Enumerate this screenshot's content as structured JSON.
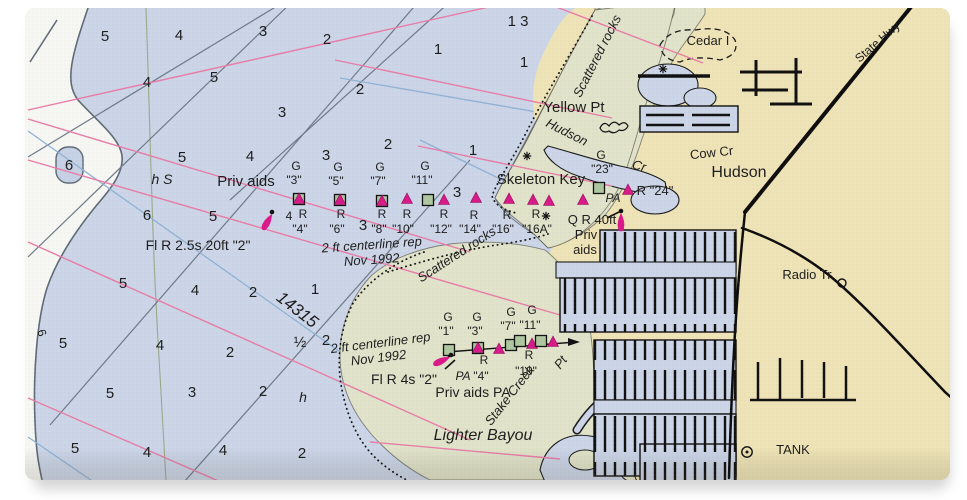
{
  "chart": {
    "chart_number": {
      "text": "14315",
      "x": 294,
      "y": 314,
      "rot": 38
    },
    "colors": {
      "water": "#cbd5e7",
      "deep": "#f6f6f2",
      "land": "#eee3b6",
      "marsh": "#e0e3c9",
      "magenta": "#d9198a",
      "green_marker": "#aec7a0",
      "pink_line": "#e87ca8",
      "blue_line": "#8fb2d4",
      "gray_line": "#6e7a88",
      "contour": "#5e6a76",
      "road": "#0d0d0d",
      "text": "#1c1c1c",
      "chart_number_blue": "#4a8fc0"
    },
    "soundings": [
      {
        "x": 105,
        "y": 41,
        "v": "5"
      },
      {
        "x": 179,
        "y": 40,
        "v": "4"
      },
      {
        "x": 263,
        "y": 36,
        "v": "3"
      },
      {
        "x": 327,
        "y": 44,
        "v": "2"
      },
      {
        "x": 438,
        "y": 54,
        "v": "1"
      },
      {
        "x": 524,
        "y": 67,
        "v": "1"
      },
      {
        "x": 360,
        "y": 94,
        "v": "2"
      },
      {
        "x": 147,
        "y": 87,
        "v": "4"
      },
      {
        "x": 214,
        "y": 82,
        "v": "5"
      },
      {
        "x": 282,
        "y": 117,
        "v": "3"
      },
      {
        "x": 182,
        "y": 162,
        "v": "5"
      },
      {
        "x": 250,
        "y": 161,
        "v": "4"
      },
      {
        "x": 147,
        "y": 220,
        "v": "6"
      },
      {
        "x": 213,
        "y": 221,
        "v": "5"
      },
      {
        "x": 326,
        "y": 160,
        "v": "3"
      },
      {
        "x": 388,
        "y": 149,
        "v": "2"
      },
      {
        "x": 473,
        "y": 155,
        "v": "1"
      },
      {
        "x": 457,
        "y": 197,
        "v": "3"
      },
      {
        "x": 363,
        "y": 230,
        "v": "3"
      },
      {
        "x": 123,
        "y": 288,
        "v": "5"
      },
      {
        "x": 195,
        "y": 295,
        "v": "4"
      },
      {
        "x": 253,
        "y": 297,
        "v": "2"
      },
      {
        "x": 315,
        "y": 294,
        "v": "1"
      },
      {
        "x": 63,
        "y": 348,
        "v": "5"
      },
      {
        "x": 160,
        "y": 350,
        "v": "4"
      },
      {
        "x": 230,
        "y": 357,
        "v": "2"
      },
      {
        "x": 300,
        "y": 347,
        "v": "½"
      },
      {
        "x": 326,
        "y": 345,
        "v": "2"
      },
      {
        "x": 110,
        "y": 398,
        "v": "5"
      },
      {
        "x": 192,
        "y": 397,
        "v": "3"
      },
      {
        "x": 263,
        "y": 396,
        "v": "2"
      },
      {
        "x": 75,
        "y": 453,
        "v": "5"
      },
      {
        "x": 147,
        "y": 457,
        "v": "4"
      },
      {
        "x": 223,
        "y": 455,
        "v": "4"
      },
      {
        "x": 302,
        "y": 458,
        "v": "2"
      },
      {
        "x": 518,
        "y": 26,
        "v": "1 3"
      },
      {
        "x": 69,
        "y": 170,
        "v": "6"
      }
    ],
    "labels": [
      {
        "t": "Priv aids",
        "x": 246,
        "y": 186,
        "s": 15
      },
      {
        "t": "Fl R 2.5s 20ft \"2\"",
        "x": 198,
        "y": 250,
        "s": 14
      },
      {
        "t": "2 ft centerline rep",
        "x": 372,
        "y": 249,
        "s": 13,
        "i": 1,
        "r": -4
      },
      {
        "t": "Nov 1992",
        "x": 372,
        "y": 264,
        "s": 13,
        "i": 1,
        "r": -4
      },
      {
        "t": "Scattered rocks",
        "x": 459,
        "y": 258,
        "s": 13,
        "i": 1,
        "r": -33
      },
      {
        "t": "Scattered rocks",
        "x": 601,
        "y": 58,
        "s": 13,
        "i": 1,
        "r": -63
      },
      {
        "t": "Yellow Pt",
        "x": 574,
        "y": 112,
        "s": 15
      },
      {
        "t": "Hudson",
        "x": 565,
        "y": 136,
        "s": 13,
        "i": 1,
        "r": 27
      },
      {
        "t": "Cr",
        "x": 638,
        "y": 170,
        "s": 13,
        "i": 1,
        "r": 15
      },
      {
        "t": "G",
        "x": 601,
        "y": 159,
        "s": 12
      },
      {
        "t": "\"23\"",
        "x": 602,
        "y": 173,
        "s": 12
      },
      {
        "t": "Skeleton Key",
        "x": 541,
        "y": 184,
        "s": 15
      },
      {
        "t": "Cedar I",
        "x": 708,
        "y": 45,
        "s": 13
      },
      {
        "t": "Cow Cr",
        "x": 712,
        "y": 157,
        "s": 13,
        "r": -6
      },
      {
        "t": "Hudson",
        "x": 739,
        "y": 177,
        "s": 16
      },
      {
        "t": "State Hwy",
        "x": 880,
        "y": 45,
        "s": 12,
        "r": -41
      },
      {
        "t": "Radio Tr",
        "x": 807,
        "y": 279,
        "s": 13
      },
      {
        "t": "TANK",
        "x": 793,
        "y": 454,
        "s": 13
      },
      {
        "t": "R \"24\"",
        "x": 655,
        "y": 195,
        "s": 13
      },
      {
        "t": "PA",
        "x": 613,
        "y": 202,
        "s": 12,
        "i": 1
      },
      {
        "t": "Q R 40ft",
        "x": 592,
        "y": 224,
        "s": 13
      },
      {
        "t": "Priv",
        "x": 586,
        "y": 239,
        "s": 13
      },
      {
        "t": "aids",
        "x": 585,
        "y": 254,
        "s": 13
      },
      {
        "t": "h S",
        "x": 162,
        "y": 184,
        "s": 14,
        "i": 1
      },
      {
        "t": "h",
        "x": 303,
        "y": 402,
        "s": 14,
        "i": 1
      },
      {
        "t": "6",
        "x": 38,
        "y": 334,
        "s": 12,
        "r": 72
      },
      {
        "t": "G",
        "x": 296,
        "y": 170,
        "s": 12
      },
      {
        "t": "\"3\"",
        "x": 294,
        "y": 184,
        "s": 12
      },
      {
        "t": "G",
        "x": 338,
        "y": 171,
        "s": 12
      },
      {
        "t": "\"5\"",
        "x": 336,
        "y": 185,
        "s": 12
      },
      {
        "t": "G",
        "x": 380,
        "y": 171,
        "s": 12
      },
      {
        "t": "\"7\"",
        "x": 378,
        "y": 185,
        "s": 12
      },
      {
        "t": "G",
        "x": 425,
        "y": 170,
        "s": 12
      },
      {
        "t": "\"11\"",
        "x": 422,
        "y": 184,
        "s": 12
      },
      {
        "t": "4",
        "x": 289,
        "y": 220,
        "s": 12
      },
      {
        "t": "R",
        "x": 303,
        "y": 218,
        "s": 12
      },
      {
        "t": "\"4\"",
        "x": 300,
        "y": 233,
        "s": 12
      },
      {
        "t": "R",
        "x": 341,
        "y": 218,
        "s": 12
      },
      {
        "t": "\"6\"",
        "x": 337,
        "y": 233,
        "s": 12
      },
      {
        "t": "R",
        "x": 382,
        "y": 218,
        "s": 12
      },
      {
        "t": "\"8\"",
        "x": 379,
        "y": 233,
        "s": 12
      },
      {
        "t": "R",
        "x": 407,
        "y": 218,
        "s": 12
      },
      {
        "t": "\"10\"",
        "x": 403,
        "y": 233,
        "s": 12
      },
      {
        "t": "R",
        "x": 444,
        "y": 218,
        "s": 12
      },
      {
        "t": "\"12\"",
        "x": 441,
        "y": 233,
        "s": 12
      },
      {
        "t": "R",
        "x": 474,
        "y": 219,
        "s": 12
      },
      {
        "t": "\"14\"",
        "x": 470,
        "y": 233,
        "s": 12
      },
      {
        "t": "R",
        "x": 507,
        "y": 219,
        "s": 12
      },
      {
        "t": "\"16\"",
        "x": 503,
        "y": 233,
        "s": 12
      },
      {
        "t": "R",
        "x": 536,
        "y": 218,
        "s": 12
      },
      {
        "t": "\"16A\"",
        "x": 537,
        "y": 233,
        "s": 12
      },
      {
        "t": "G",
        "x": 448,
        "y": 321,
        "s": 12
      },
      {
        "t": "\"1\"",
        "x": 446,
        "y": 335,
        "s": 12
      },
      {
        "t": "G",
        "x": 477,
        "y": 321,
        "s": 12
      },
      {
        "t": "\"3\"",
        "x": 475,
        "y": 335,
        "s": 12
      },
      {
        "t": "G",
        "x": 511,
        "y": 316,
        "s": 12
      },
      {
        "t": "\"7\"",
        "x": 508,
        "y": 330,
        "s": 12
      },
      {
        "t": "G",
        "x": 532,
        "y": 314,
        "s": 12
      },
      {
        "t": "\"11\"",
        "x": 530,
        "y": 329,
        "s": 12
      },
      {
        "t": "PA",
        "x": 463,
        "y": 380,
        "s": 12,
        "i": 1
      },
      {
        "t": "R",
        "x": 484,
        "y": 364,
        "s": 12
      },
      {
        "t": "\"4\"",
        "x": 481,
        "y": 380,
        "s": 12
      },
      {
        "t": "R",
        "x": 529,
        "y": 359,
        "s": 12
      },
      {
        "t": "\"10\"",
        "x": 526,
        "y": 375,
        "s": 12
      },
      {
        "t": "Fl R 4s \"2\"",
        "x": 404,
        "y": 384,
        "s": 14
      },
      {
        "t": "Priv aids PA",
        "x": 473,
        "y": 397,
        "s": 14
      },
      {
        "t": "2 ft centerline rep",
        "x": 381,
        "y": 347,
        "s": 13,
        "i": 1,
        "r": -7
      },
      {
        "t": "Nov 1992",
        "x": 379,
        "y": 362,
        "s": 13,
        "i": 1,
        "r": -7
      },
      {
        "t": "Stake Creek",
        "x": 513,
        "y": 398,
        "s": 13,
        "i": 1,
        "r": -52
      },
      {
        "t": "Pt",
        "x": 564,
        "y": 365,
        "s": 13,
        "i": 1,
        "r": -52
      },
      {
        "t": "Lighter Bayou",
        "x": 483,
        "y": 440,
        "s": 16,
        "i": 1
      }
    ],
    "nav_markers": [
      {
        "k": "gsq-tri",
        "x": 299,
        "y": 199
      },
      {
        "k": "gsq-tri",
        "x": 340,
        "y": 200
      },
      {
        "k": "gsq-tri",
        "x": 382,
        "y": 201
      },
      {
        "k": "tri",
        "x": 407,
        "y": 199
      },
      {
        "k": "gsq",
        "x": 428,
        "y": 200
      },
      {
        "k": "tri",
        "x": 444,
        "y": 200
      },
      {
        "k": "tri",
        "x": 476,
        "y": 198
      },
      {
        "k": "tri",
        "x": 509,
        "y": 199
      },
      {
        "k": "tri",
        "x": 533,
        "y": 200
      },
      {
        "k": "tri",
        "x": 549,
        "y": 201
      },
      {
        "k": "tri",
        "x": 583,
        "y": 200
      },
      {
        "k": "gsq",
        "x": 599,
        "y": 188
      },
      {
        "k": "tri",
        "x": 628,
        "y": 190
      },
      {
        "k": "gsq",
        "x": 449,
        "y": 350
      },
      {
        "k": "gsq-tri",
        "x": 478,
        "y": 348
      },
      {
        "k": "tri",
        "x": 499,
        "y": 349
      },
      {
        "k": "gsq",
        "x": 511,
        "y": 345
      },
      {
        "k": "gsq",
        "x": 520,
        "y": 341
      },
      {
        "k": "tri",
        "x": 532,
        "y": 344
      },
      {
        "k": "gsq",
        "x": 541,
        "y": 341
      },
      {
        "k": "tri",
        "x": 553,
        "y": 342
      },
      {
        "k": "dot",
        "x": 272,
        "y": 212
      },
      {
        "k": "flare",
        "x": 272,
        "y": 214,
        "r": 30
      },
      {
        "k": "dot",
        "x": 621,
        "y": 211
      },
      {
        "k": "flare",
        "x": 621,
        "y": 213,
        "r": 0
      },
      {
        "k": "dot",
        "x": 451,
        "y": 355
      },
      {
        "k": "flare",
        "x": 450,
        "y": 357,
        "r": 65
      },
      {
        "k": "star",
        "x": 527,
        "y": 156
      },
      {
        "k": "star",
        "x": 546,
        "y": 216
      },
      {
        "k": "star",
        "x": 663,
        "y": 69
      },
      {
        "k": "circle-dot",
        "x": 747,
        "y": 452
      },
      {
        "k": "circle",
        "x": 842,
        "y": 283
      }
    ]
  }
}
